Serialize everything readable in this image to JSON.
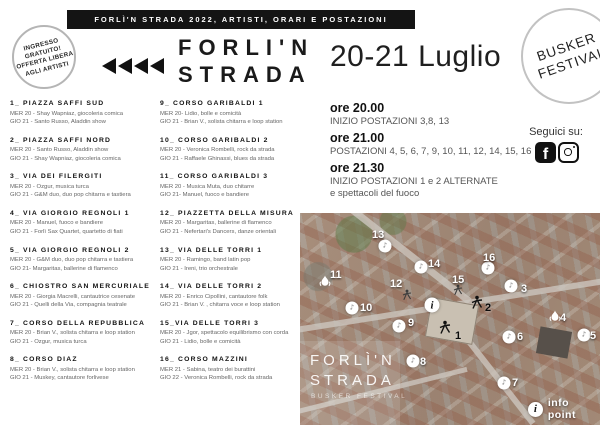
{
  "colors": {
    "banner_bg": "#141414",
    "text_dark": "#1a1a1a",
    "text_gray": "#666666",
    "circle_border": "#b5b5b5"
  },
  "banner": {
    "text": "FORLÌ'N STRADA 2022, ARTISTI, ORARI E POSTAZIONI"
  },
  "free_badge": {
    "line1": "INGRESSO",
    "line2": "GRATUITO!",
    "line3": "OFFERTA LIBERA",
    "line4": "AGLI ARTISTI"
  },
  "logo": {
    "line1": "FORLI'N",
    "line2": "STRADA"
  },
  "header": {
    "date": "20-21 Luglio"
  },
  "busker_badge": {
    "line1": "BUSKER",
    "line2": "FESTIVAL"
  },
  "schedule": [
    {
      "time": "ore 20.00",
      "lines": [
        "INIZIO POSTAZIONI 3,8, 13"
      ]
    },
    {
      "time": "ore 21.00",
      "lines": [
        "POSTAZIONI 4, 5, 6, 7, 9, 10, 11, 12, 14, 15, 16"
      ]
    },
    {
      "time": "ore 21.30",
      "lines": [
        "INIZIO POSTAZIONI  1 e 2 ALTERNATE",
        "e spettacoli del fuoco"
      ]
    }
  ],
  "social": {
    "label": "Seguici su:",
    "facebook": "f"
  },
  "locations": {
    "col1": [
      {
        "title": "1_ PIAZZA SAFFI SUD",
        "lines": [
          "MER 20 - Shay Wapniaz, giocoleria comica",
          "GIO 21 - Santo Russo, Aladdin show"
        ]
      },
      {
        "title": "2_ PIAZZA SAFFI NORD",
        "lines": [
          "MER 20 - Santo Russo, Aladdin show",
          "GIO 21 - Shay Wapniaz, giocoleria comica"
        ]
      },
      {
        "title": "3_ VIA DEI FILERGITI",
        "lines": [
          "MER 20 - Ozgur, musica turca",
          "GIO 21 - G&M duo, duo pop chitarra e tastiera"
        ]
      },
      {
        "title": "4_ VIA GIORGIO REGNOLI 1",
        "lines": [
          "MER 20 - Manuel, fuoco e bandiere",
          "GIO 21 - Forlì Sax Quartet, quartetto di fiati"
        ]
      },
      {
        "title": "5_ VIA GIORGIO REGNOLI 2",
        "lines": [
          "MER 20 - G&M duo, duo pop chitarra e tastiera",
          "GIO 21- Margaritas, ballerine di flamenco"
        ]
      },
      {
        "title": "6_ CHIOSTRO SAN MERCURIALE",
        "lines": [
          "MER 20 - Giorgia Macrelli, cantautrice cesenate",
          "GIO 21 - Quelli della Via, compagnia teatrale"
        ]
      },
      {
        "title": "7_ CORSO DELLA REPUBBLICA",
        "lines": [
          "MER 20 - Brian V., solista chitarra e loop station",
          "GIO 21 - Ozgur, musica turca"
        ]
      },
      {
        "title": "8_ CORSO DIAZ",
        "lines": [
          "MER 20 - Brian V., solista chitarra e loop station",
          "GIO 21 - Muskey, cantautore forlivese"
        ]
      }
    ],
    "col2": [
      {
        "title": "9_ CORSO GARIBALDI 1",
        "lines": [
          "MER 20- Lidio, bolle e comicità",
          "GIO 21 - Brian V., solista chitarra e loop station"
        ]
      },
      {
        "title": "10_ CORSO GARIBALDI 2",
        "lines": [
          "MER 20 - Veronica Rombelli, rock da strada",
          "GIO 21 - Raffaele Ghinassi, blues da strada"
        ]
      },
      {
        "title": "11_ CORSO GARIBALDI 3",
        "lines": [
          "MER 20 - Musica Muta, duo chitarre",
          "GIO 21- Manuel, fuoco e bandiere"
        ]
      },
      {
        "title": "12_ PIAZZETTA DELLA MISURA",
        "lines": [
          "MER 20 - Margaritas, ballerine di flamenco",
          "GIO 21 - Nefertari's Dancers, danze orientali"
        ]
      },
      {
        "title": "13_ VIA DELLE TORRI 1",
        "lines": [
          "MER 20 - Ramingo, band latin pop",
          "GIO 21 - Ireni, trio orchestrale"
        ]
      },
      {
        "title": "14_ VIA DELLE TORRI 2",
        "lines": [
          "MER 20 - Enrico Cipollini, cantautore folk",
          "GIO 21 - Brian V. , chitarra voce e loop station"
        ]
      },
      {
        "title": "15_VIA DELLE TORRI 3",
        "lines": [
          "MER 20 - Jgor, spettacolo equilibrismo con corda",
          "GIO 21 - Lidio, bolle e comicità"
        ]
      },
      {
        "title": "16_ CORSO MAZZINI",
        "lines": [
          "MER 21 - Sabina, teatro dei burattini",
          "GIO 22 - Veronica Rombelli, rock da strada"
        ]
      }
    ]
  },
  "map": {
    "overlay_title_line1": "FORLÌ'N",
    "overlay_title_line2": "STRADA",
    "overlay_subtitle": "BUSKER FESTIVAL",
    "legend_label": "info point",
    "info_symbol": "i",
    "markers": [
      {
        "label": "13",
        "type": "spot",
        "x": 85,
        "y": 33,
        "lx": 72,
        "ly": 17
      },
      {
        "label": "14",
        "type": "spot",
        "x": 121,
        "y": 54,
        "lx": 128,
        "ly": 46
      },
      {
        "label": "16",
        "type": "spot",
        "x": 188,
        "y": 55,
        "lx": 183,
        "ly": 40
      },
      {
        "label": "11",
        "type": "flame",
        "x": 25,
        "y": 72,
        "lx": 30,
        "ly": 57
      },
      {
        "label": "12",
        "type": "figure-small",
        "x": 107,
        "y": 84,
        "lx": 90,
        "ly": 66
      },
      {
        "label": "15",
        "type": "figure-small",
        "x": 158,
        "y": 79,
        "lx": 152,
        "ly": 62
      },
      {
        "label": "3",
        "type": "spot",
        "x": 211,
        "y": 73,
        "lx": 221,
        "ly": 71
      },
      {
        "label": "10",
        "type": "spot",
        "x": 52,
        "y": 95,
        "lx": 60,
        "ly": 90
      },
      {
        "label": "i",
        "type": "info",
        "x": 132,
        "y": 92
      },
      {
        "label": "2",
        "type": "figure",
        "x": 177,
        "y": 92,
        "lx": 185,
        "ly": 90,
        "dark": true
      },
      {
        "label": "9",
        "type": "spot",
        "x": 99,
        "y": 113,
        "lx": 108,
        "ly": 105
      },
      {
        "label": "4",
        "type": "flame",
        "x": 255,
        "y": 107,
        "lx": 260,
        "ly": 100
      },
      {
        "label": "5",
        "type": "spot",
        "x": 284,
        "y": 122,
        "lx": 290,
        "ly": 118
      },
      {
        "label": "6",
        "type": "spot",
        "x": 209,
        "y": 124,
        "lx": 217,
        "ly": 119
      },
      {
        "label": "1",
        "type": "figure",
        "x": 145,
        "y": 117,
        "lx": 155,
        "ly": 118,
        "dark": true
      },
      {
        "label": "8",
        "type": "spot",
        "x": 113,
        "y": 148,
        "lx": 120,
        "ly": 144
      },
      {
        "label": "7",
        "type": "spot",
        "x": 204,
        "y": 170,
        "lx": 212,
        "ly": 165
      }
    ]
  }
}
